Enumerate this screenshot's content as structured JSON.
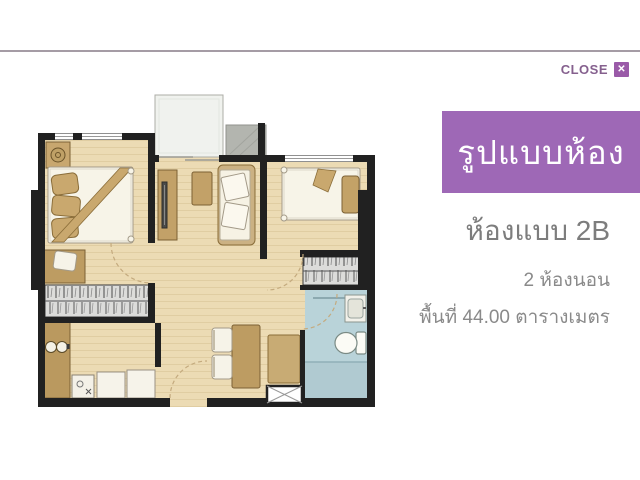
{
  "close": {
    "label": "CLOSE",
    "icon_glyph": "✕"
  },
  "banner": {
    "title": "รูปแบบห้อง"
  },
  "unit_info": {
    "type_label": "ห้องแบบ 2B",
    "bedrooms": "2 ห้องนอน",
    "area": "พื้นที่ 44.00 ตารางเมตร"
  },
  "colors": {
    "banner_purple": "#9e68b6",
    "close_icon_purple": "#9a5aa8",
    "close_text_purple": "#85608e",
    "divider_gray": "#a59ca5",
    "info_text_gray": "#8a8a8a",
    "wall_black": "#212121",
    "floor_tan": "#ecdbb4",
    "furniture_tan": "#c2a168",
    "counter_tan": "#ba995f",
    "bathroom_blue": "#b9d3d9",
    "balcony_gray": "#f0f2ee",
    "ac_ledge_gray": "#b3b5af"
  },
  "floorplan_features": [
    "balcony",
    "ac-ledge",
    "bedroom-1-bed",
    "nightstand-lamp",
    "dressing-desk",
    "wardrobe-left",
    "kitchen-counter",
    "stove-burners",
    "kitchen-sink",
    "refrigerator",
    "appliance",
    "tv-cabinet",
    "coffee-table",
    "sofa",
    "dining-table",
    "dining-chairs",
    "sideboard",
    "bedroom-2-bed",
    "wardrobe-right",
    "bathroom",
    "toilet",
    "bathroom-sink",
    "shower-area",
    "service-shaft",
    "entry-door-arc"
  ]
}
